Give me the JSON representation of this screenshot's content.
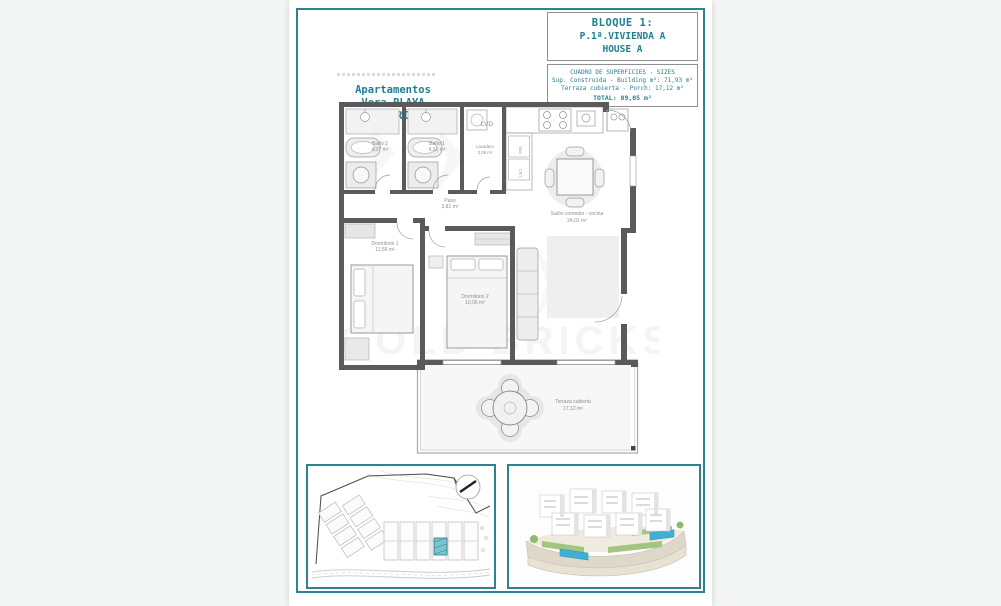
{
  "colors": {
    "accent": "#2e8294",
    "teal_text": "#1e7f91",
    "wall": "#5a5a5a",
    "highlight": "#3fa7bc",
    "pool": "#3fb0d4"
  },
  "title_block": {
    "bloque": "BLOQUE 1:",
    "vivienda": "P.1ª.VIVIENDA A",
    "house": "HOUSE A",
    "table_header": "CUADRO DE SUPERFICIES - SIZES",
    "row_building": "Sup. Construida - Building m²: 71,93 m²",
    "row_porch": "Terraza cubierta - Porch: 17,12 m²",
    "row_total": "TOTAL: 89,05 m²"
  },
  "project_title": {
    "line1": "Apartamentos",
    "line2": "Vera PLAYA",
    "line3": "(ALMERÍA)"
  },
  "floor_plan": {
    "watermark": "GOLD BRICKS",
    "labels": {
      "lvd": "LVD",
      "fri": "FRI",
      "lvj": "LVJ"
    },
    "rooms": [
      {
        "name": "Baño 2",
        "area": "4,37 m²"
      },
      {
        "name": "Baño 1",
        "area": "4,31 m²"
      },
      {
        "name": "Lavadero",
        "area": "2,08 m²"
      },
      {
        "name": "Paso",
        "area": "3,81 m²"
      },
      {
        "name": "Salón comedor - cocina",
        "area": "24,01 m²"
      },
      {
        "name": "Dormitorio 1",
        "area": "11,56 m²"
      },
      {
        "name": "Dormitorio 2",
        "area": "10,06 m²"
      },
      {
        "name": "Terraza cubierta",
        "area": "17,12 m²"
      }
    ]
  }
}
